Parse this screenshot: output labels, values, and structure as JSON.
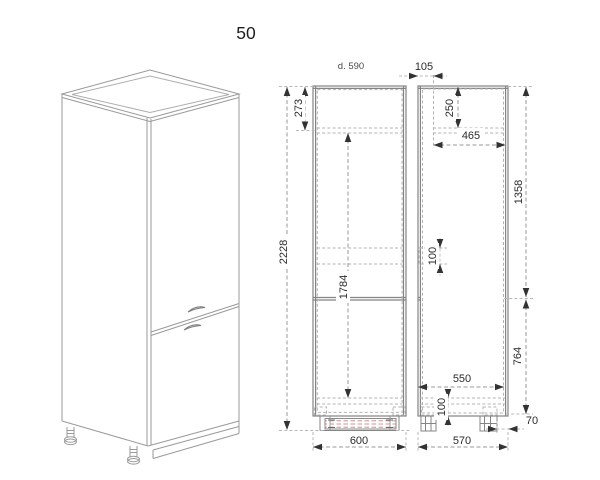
{
  "title": "50",
  "front_view": {
    "depth_note": "d. 590",
    "total_height": "2228",
    "top_section_height": "273",
    "interior_height": "1784",
    "overall_width": "600"
  },
  "side_view": {
    "front_offset": "105",
    "top_section_height": "250",
    "top_inner_depth": "465",
    "upper_zone_height": "1358",
    "mid_detail_height": "100",
    "lower_zone_height": "764",
    "bottom_inner_depth": "550",
    "plinth_detail_height": "100",
    "back_recess": "70",
    "overall_depth": "570"
  },
  "colors": {
    "outline": "#8a8a8a",
    "construction": "#b3b3b3",
    "dimension_line": "#9a9a9a",
    "dimension_text": "#2b2b2b",
    "hatch": "#cc9191"
  }
}
